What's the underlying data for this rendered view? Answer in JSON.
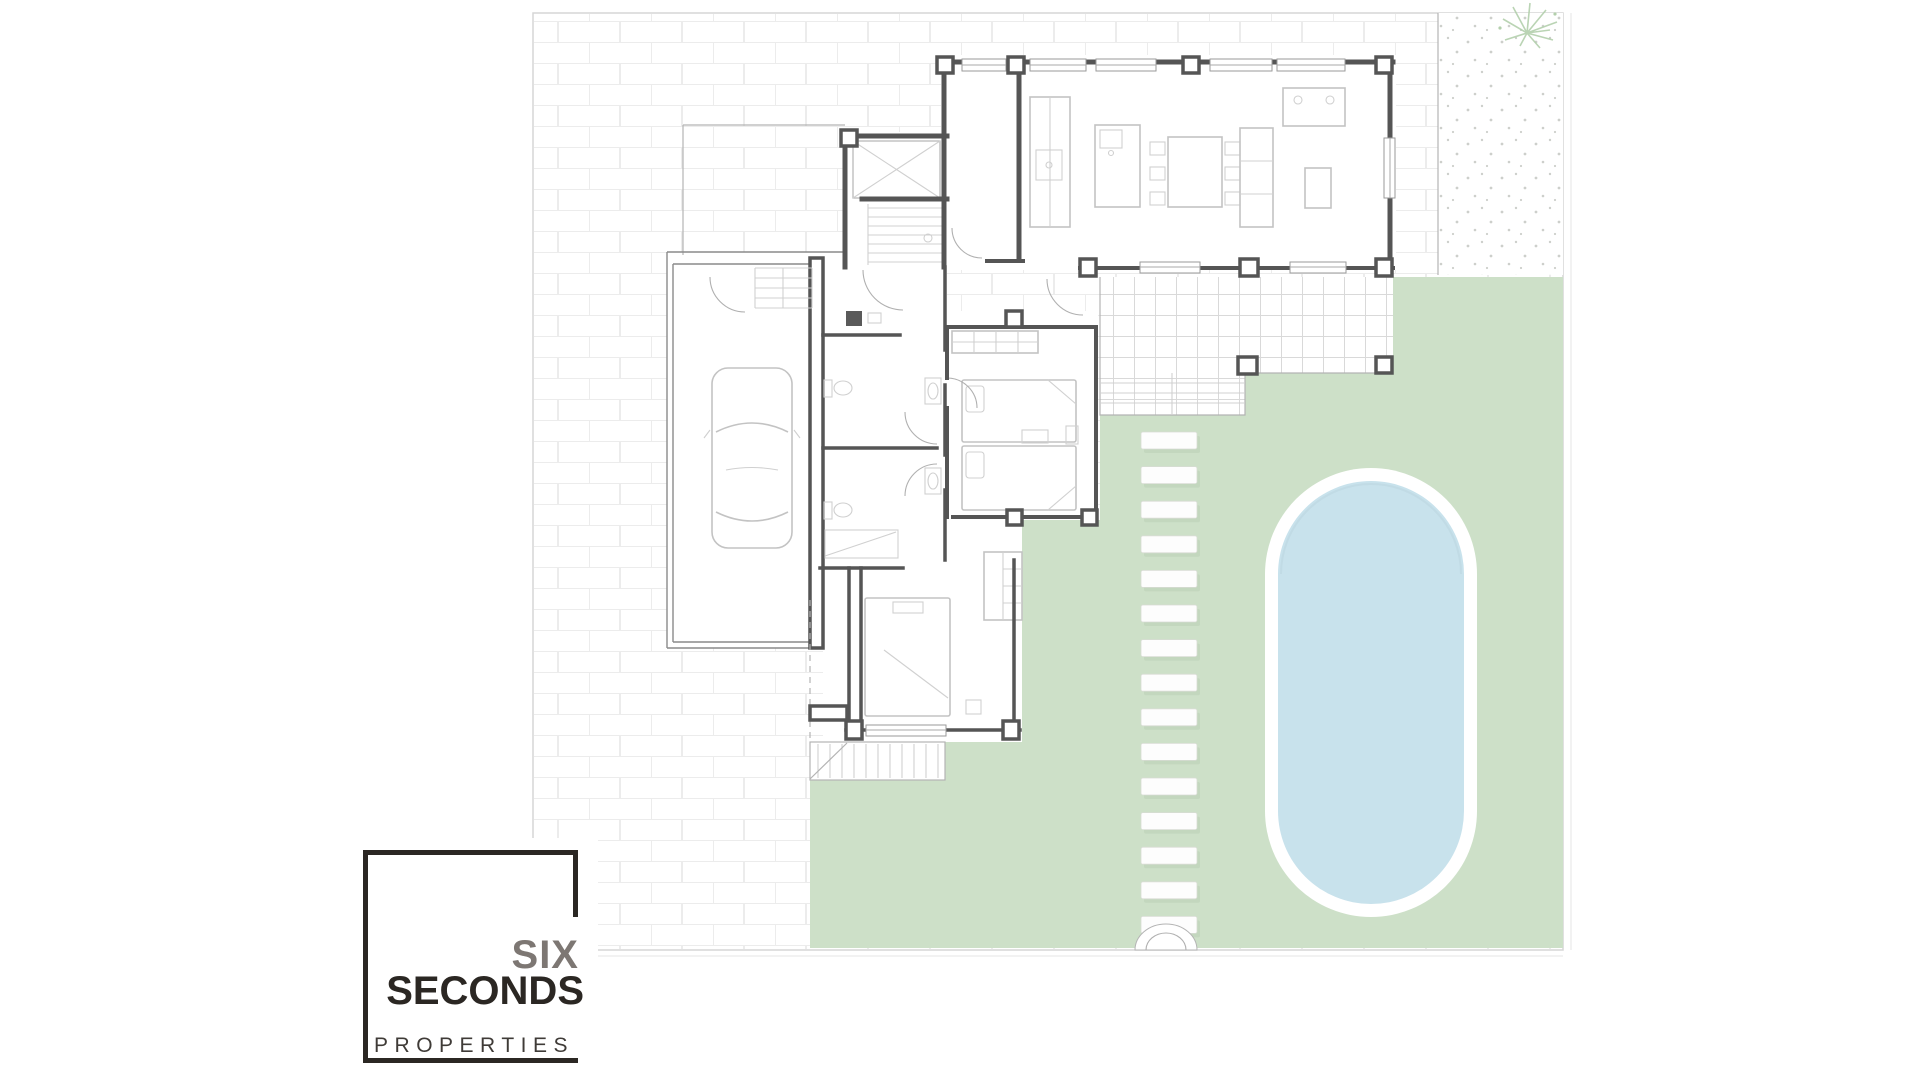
{
  "logo": {
    "word_top": "SIX",
    "word_main": "SECONDS",
    "word_sub": "PROPERTIES"
  },
  "plan": {
    "colors": {
      "lawn": "#cde0c8",
      "pool-water": "#c8e2ec",
      "pool-rim": "#ffffff",
      "wall": "#555555",
      "brick-line": "#ececec",
      "tile-line": "#d9d9d9",
      "gravel-dot": "#a4a8a0",
      "plant": "#b3cfac",
      "stone-shadow": "#b9cdb4",
      "logo-dark": "#2b2723",
      "logo-gray": "#7d7773",
      "logo-sub": "#3f3b37"
    },
    "regions": [
      "paved-yard",
      "lawn",
      "gravel-bed",
      "swimming-pool",
      "stepping-stone-path",
      "terrace",
      "garage",
      "staircase",
      "entry-porch",
      "bathrooms",
      "bedroom-main",
      "bedroom-second",
      "living-kitchen",
      "deck-steps"
    ]
  }
}
